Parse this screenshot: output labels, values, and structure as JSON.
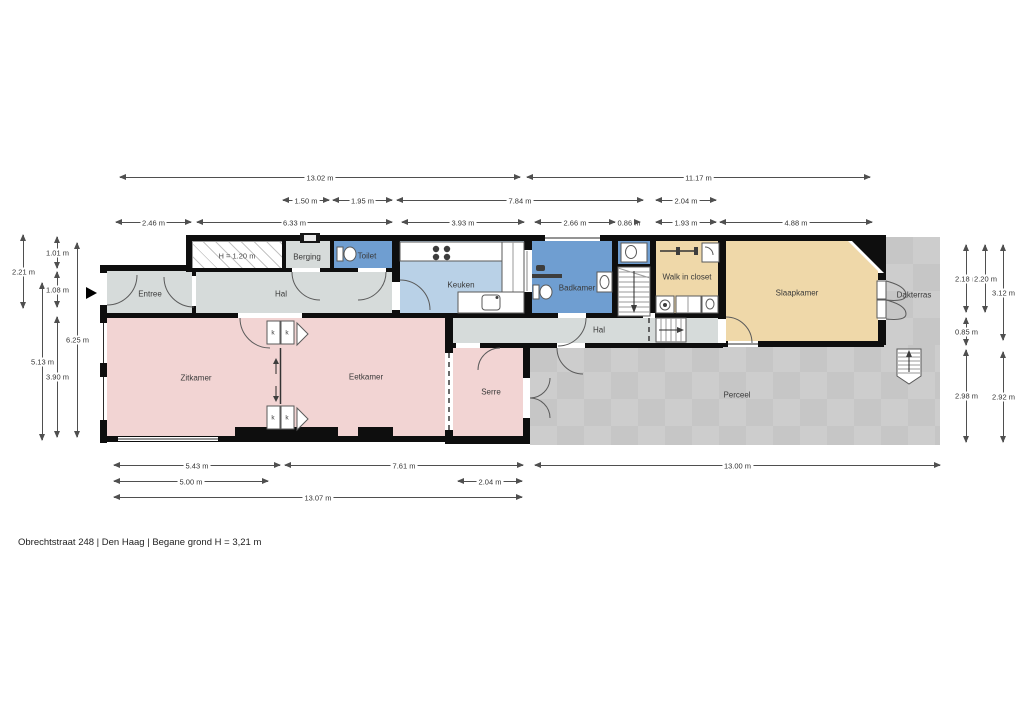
{
  "footer": {
    "text": "Obrechtstraat 248 |  Den Haag  |  Begane grond H = 3,21 m"
  },
  "rooms": {
    "entree": "Entree",
    "hal1": "Hal",
    "berging": "Berging",
    "toilet": "Toilet",
    "keuken": "Keuken",
    "badkamer": "Badkamer",
    "walk_in_closet": "Walk in closet",
    "slaapkamer": "Slaapkamer",
    "dakterras": "Dakterras",
    "hal2": "Hal",
    "zitkamer": "Zitkamer",
    "eetkamer": "Eetkamer",
    "serre": "Serre",
    "perceel": "Perceel"
  },
  "annotations": {
    "height_restriction": "H = 1.20 m",
    "closet_marker": "k"
  },
  "dimensions": {
    "horizontal": [
      "13.02 m",
      "11.17 m",
      "1.50 m",
      "1.95 m",
      "7.84 m",
      "2.04 m",
      "2.46 m",
      "6.33 m",
      "3.93 m",
      "2.66 m",
      "0.86 m",
      "1.93 m",
      "4.88 m",
      "5.43 m",
      "7.61 m",
      "13.00 m",
      "5.00 m",
      "2.04 m",
      "13.07 m"
    ],
    "vertical": [
      "2.21 m",
      "5.13 m",
      "1.01 m",
      "1.08 m",
      "3.90 m",
      "6.25 m",
      "2.18 m",
      "0.85 m",
      "2.98 m",
      "2.20 m",
      "3.12 m",
      "2.92 m"
    ]
  },
  "colors": {
    "wall": "#0e0e0e",
    "hall": "#d6dbda",
    "wet": "#6f9ed1",
    "kitchen": "#b9d1e7",
    "bedroom": "#efd8a9",
    "living": "#f2d4d3",
    "outdoor_light": "#cdcdcd",
    "outdoor_dark": "#c6c6c6",
    "dimension": "#4f4f4f"
  }
}
